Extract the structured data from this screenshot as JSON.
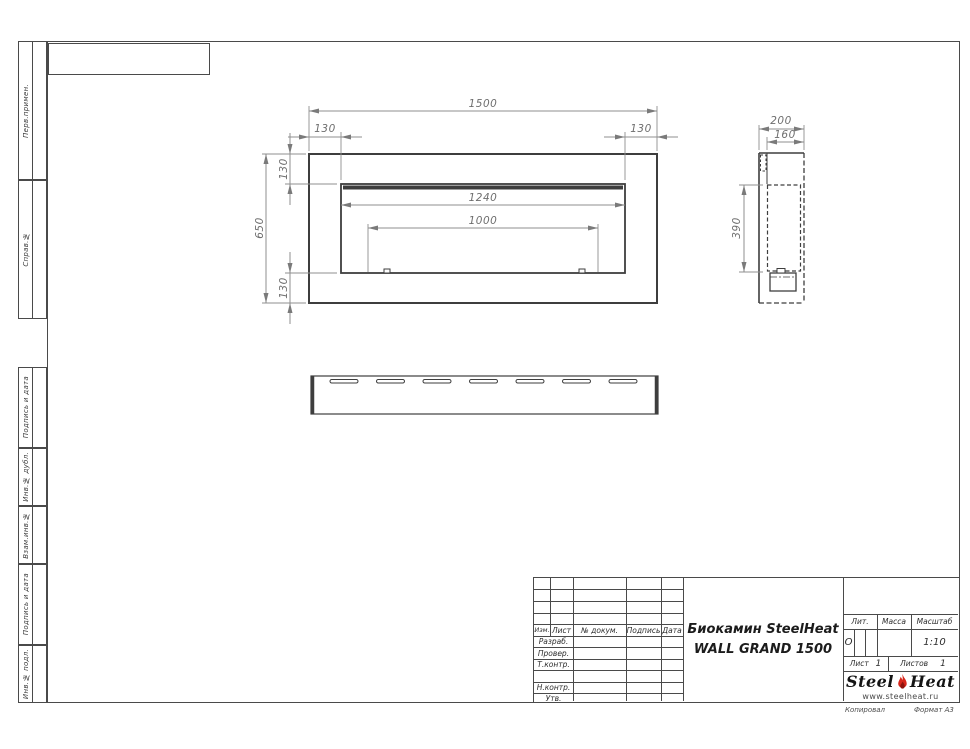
{
  "drawing": {
    "dims": {
      "total_width": "1500",
      "flange_left": "130",
      "flange_right": "130",
      "total_height": "650",
      "flange_top": "130",
      "flange_bottom": "130",
      "opening_width": "1240",
      "burner_width": "1000",
      "depth": "200",
      "inner_depth": "160",
      "opening_height": "390"
    }
  },
  "margin_labels": [
    "Перв.примен.",
    "Справ.№",
    "Подпись и дата",
    "Инв.№ дубл.",
    "Взам.инв.№",
    "Подпись и дата",
    "Инв.№ подл."
  ],
  "title_block": {
    "col_izm": "Изм.",
    "col_list": "Лист",
    "col_doc": "№ докум.",
    "col_sign": "Подпись",
    "col_date": "Дата",
    "row_razrab": "Разраб.",
    "row_prover": "Провер.",
    "row_tkontr": "Т.контр.",
    "row_nkontr": "Н.контр.",
    "row_utv": "Утв.",
    "title_line1": "Биокамин SteelHeat",
    "title_line2": "WALL GRAND 1500",
    "lit_label": "Лит.",
    "lit_value": "О",
    "mass_label": "Масса",
    "scale_label": "Масштаб",
    "scale_value": "1:10",
    "sheet_label": "Лист",
    "sheet_value": "1",
    "sheets_label": "Листов",
    "sheets_value": "1",
    "brand_left": "Steel",
    "brand_right": "Heat",
    "brand_site": "www.steelheat.ru",
    "accent_color": "#d7261b"
  },
  "footer": {
    "copied": "Копировал",
    "format": "Формат А3"
  }
}
